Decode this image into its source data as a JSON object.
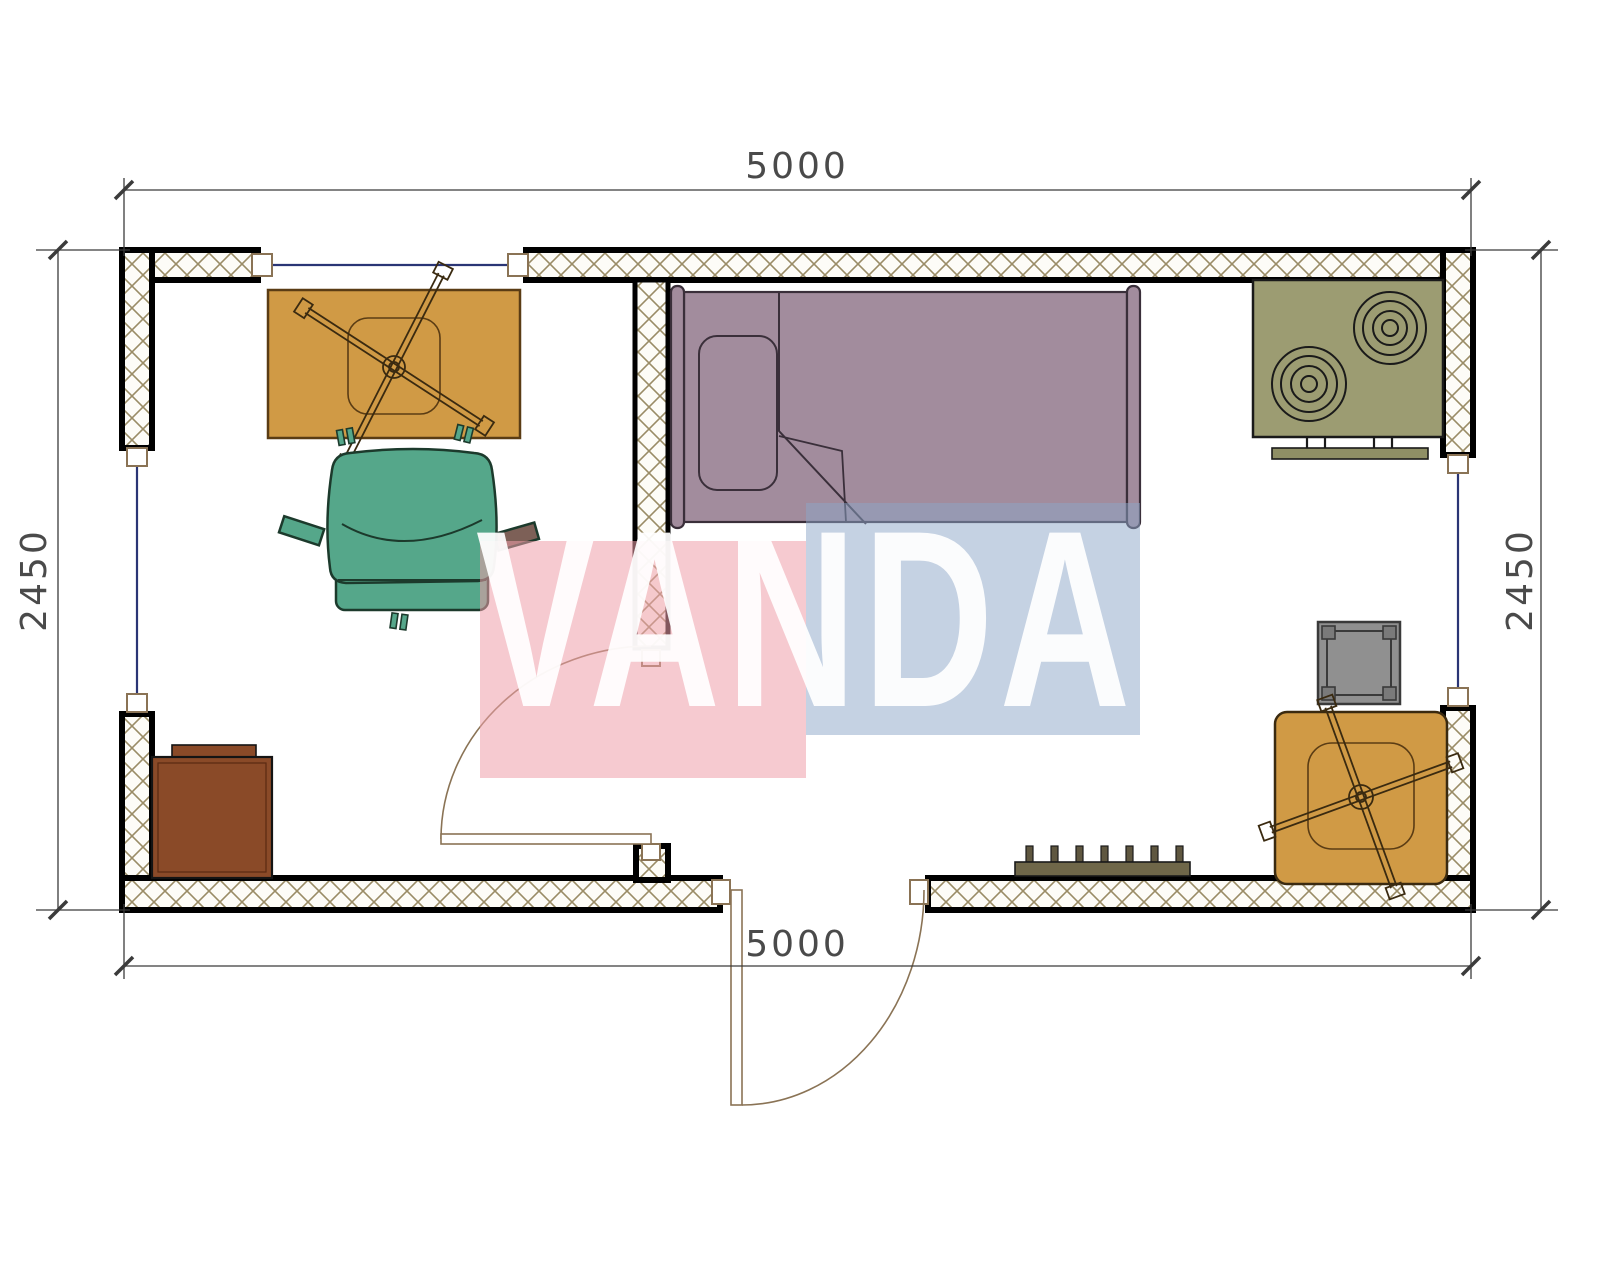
{
  "document": {
    "type": "floor-plan",
    "description": "Top-view architectural floor plan of a 5000x2450 container cabin with two rooms, watermarked VANDA"
  },
  "dimensions": {
    "top": "5000",
    "bottom": "5000",
    "left": "2450",
    "right": "2450"
  },
  "watermark": {
    "text": "VANDA",
    "pink": "#ee9eaa",
    "blue": "#8ca5c8",
    "text_color": "#ffffff"
  },
  "plan": {
    "wall_border": "#000000",
    "hatch_color": "#9a8c66",
    "window_glass": "#2a3575",
    "window_frame": "#8a7355",
    "door_swing": "#8a7355",
    "dim_line": "#3b3b3b"
  },
  "furniture": {
    "dining_table": {
      "name": "dining table with ceiling fan symbol",
      "fill": "#d09a45",
      "outline": "#5a3c14"
    },
    "armchair": {
      "name": "green armchair",
      "fill": "#55a78a",
      "outline": "#1c3a2c"
    },
    "bed": {
      "name": "single bed with pillow",
      "fill": "#a28c9d",
      "outline": "#3a2f3a"
    },
    "stove": {
      "name": "two-burner stove",
      "fill": "#9c9c72",
      "handle": "#8f8f65"
    },
    "cabinet": {
      "name": "brown cabinet",
      "fill": "#8a4a28"
    },
    "stool": {
      "name": "gray square stool",
      "fill": "#909090",
      "corner": "#7a7a7a"
    },
    "square_table": {
      "name": "square table with fan symbol",
      "fill": "#d09a45",
      "outline": "#3a2a10"
    },
    "coat_rack": {
      "name": "wall coat rack with pegs",
      "fill": "#6f6749",
      "peg": "#5f5740"
    }
  }
}
